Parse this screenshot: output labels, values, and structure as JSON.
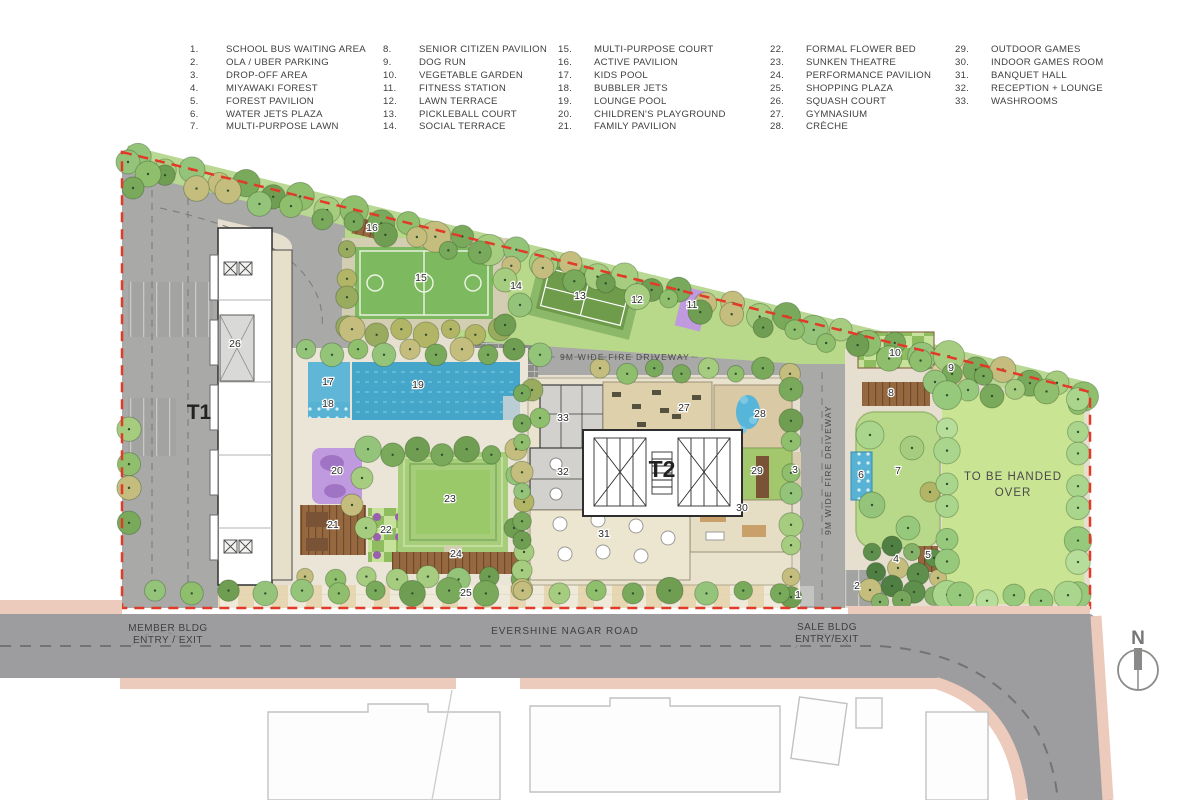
{
  "legend": {
    "columns": [
      {
        "items": [
          {
            "num": "1.",
            "label": "SCHOOL BUS WAITING AREA"
          },
          {
            "num": "2.",
            "label": "OLA / UBER PARKING"
          },
          {
            "num": "3.",
            "label": "DROP-OFF AREA"
          },
          {
            "num": "4.",
            "label": "MIYAWAKI FOREST"
          },
          {
            "num": "5.",
            "label": "FOREST PAVILION"
          },
          {
            "num": "6.",
            "label": "WATER JETS PLAZA"
          },
          {
            "num": "7.",
            "label": "MULTI-PURPOSE LAWN"
          }
        ]
      },
      {
        "items": [
          {
            "num": "8.",
            "label": "SENIOR CITIZEN PAVILION"
          },
          {
            "num": "9.",
            "label": "DOG RUN"
          },
          {
            "num": "10.",
            "label": "VEGETABLE GARDEN"
          },
          {
            "num": "11.",
            "label": "FITNESS STATION"
          },
          {
            "num": "12.",
            "label": "LAWN TERRACE"
          },
          {
            "num": "13.",
            "label": "PICKLEBALL COURT"
          },
          {
            "num": "14.",
            "label": "SOCIAL TERRACE"
          }
        ]
      },
      {
        "items": [
          {
            "num": "15.",
            "label": "MULTI-PURPOSE COURT"
          },
          {
            "num": "16.",
            "label": "ACTIVE PAVILION"
          },
          {
            "num": "17.",
            "label": "KIDS POOL"
          },
          {
            "num": "18.",
            "label": "BUBBLER JETS"
          },
          {
            "num": "19.",
            "label": "LOUNGE POOL"
          },
          {
            "num": "20.",
            "label": "CHILDREN'S PLAYGROUND"
          },
          {
            "num": "21.",
            "label": "FAMILY PAVILION"
          }
        ]
      },
      {
        "items": [
          {
            "num": "22.",
            "label": "FORMAL FLOWER BED"
          },
          {
            "num": "23.",
            "label": "SUNKEN THEATRE"
          },
          {
            "num": "24.",
            "label": "PERFORMANCE PAVILION"
          },
          {
            "num": "25.",
            "label": "SHOPPING PLAZA"
          },
          {
            "num": "26.",
            "label": "SQUASH COURT"
          },
          {
            "num": "27.",
            "label": "GYMNASIUM"
          },
          {
            "num": "28.",
            "label": "CRÈCHE"
          }
        ]
      },
      {
        "items": [
          {
            "num": "29.",
            "label": "OUTDOOR GAMES"
          },
          {
            "num": "30.",
            "label": "INDOOR GAMES ROOM"
          },
          {
            "num": "31.",
            "label": "BANQUET HALL"
          },
          {
            "num": "32.",
            "label": "RECEPTION + LOUNGE"
          },
          {
            "num": "33.",
            "label": "WASHROOMS"
          }
        ]
      }
    ]
  },
  "plan": {
    "labels": {
      "t1": "T1",
      "t2": "T2",
      "handed_over_line1": "TO BE HANDED",
      "handed_over_line2": "OVER",
      "fire_driveway": "9M WIDE FIRE DRIVEWAY",
      "member_entry_line1": "MEMBER BLDG",
      "member_entry_line2": "ENTRY / EXIT",
      "road_name": "EVERSHINE NAGAR ROAD",
      "sale_entry_line1": "SALE BLDG",
      "sale_entry_line2": "ENTRY/EXIT",
      "north": "N"
    },
    "markers": [
      {
        "n": "1",
        "x": 798,
        "y": 598
      },
      {
        "n": "2",
        "x": 857,
        "y": 589
      },
      {
        "n": "3",
        "x": 795,
        "y": 473
      },
      {
        "n": "4",
        "x": 896,
        "y": 562
      },
      {
        "n": "5",
        "x": 928,
        "y": 558
      },
      {
        "n": "6",
        "x": 861,
        "y": 478
      },
      {
        "n": "7",
        "x": 898,
        "y": 474
      },
      {
        "n": "8",
        "x": 891,
        "y": 396
      },
      {
        "n": "9",
        "x": 951,
        "y": 371
      },
      {
        "n": "10",
        "x": 895,
        "y": 356
      },
      {
        "n": "11",
        "x": 692,
        "y": 308
      },
      {
        "n": "12",
        "x": 637,
        "y": 303
      },
      {
        "n": "13",
        "x": 580,
        "y": 299
      },
      {
        "n": "14",
        "x": 516,
        "y": 289
      },
      {
        "n": "15",
        "x": 421,
        "y": 281
      },
      {
        "n": "16",
        "x": 372,
        "y": 231
      },
      {
        "n": "17",
        "x": 328,
        "y": 385
      },
      {
        "n": "18",
        "x": 328,
        "y": 407
      },
      {
        "n": "19",
        "x": 418,
        "y": 388
      },
      {
        "n": "20",
        "x": 337,
        "y": 474
      },
      {
        "n": "21",
        "x": 333,
        "y": 528
      },
      {
        "n": "22",
        "x": 386,
        "y": 533
      },
      {
        "n": "23",
        "x": 450,
        "y": 502
      },
      {
        "n": "24",
        "x": 456,
        "y": 557
      },
      {
        "n": "25",
        "x": 466,
        "y": 596
      },
      {
        "n": "26",
        "x": 235,
        "y": 347
      },
      {
        "n": "27",
        "x": 684,
        "y": 411
      },
      {
        "n": "28",
        "x": 760,
        "y": 417
      },
      {
        "n": "29",
        "x": 757,
        "y": 474
      },
      {
        "n": "30",
        "x": 742,
        "y": 511
      },
      {
        "n": "31",
        "x": 604,
        "y": 537
      },
      {
        "n": "32",
        "x": 563,
        "y": 475
      },
      {
        "n": "33",
        "x": 563,
        "y": 421
      }
    ]
  },
  "colors": {
    "boundary_red": "#e23a28",
    "road_gray": "#a9a9a7",
    "main_road_gray": "#9d9da0",
    "pool_blue": "#45a6c9",
    "lawn_green": "#b9d98a",
    "handed_lawn": "#c9e493",
    "court_green": "#7db95e",
    "pickleball_green": "#6f9c4a",
    "playground_purple": "#c09ade",
    "deck_brown": "#96683f",
    "paving_beige": "#e6dfd0",
    "sidewalk_pink": "#eccabc"
  }
}
